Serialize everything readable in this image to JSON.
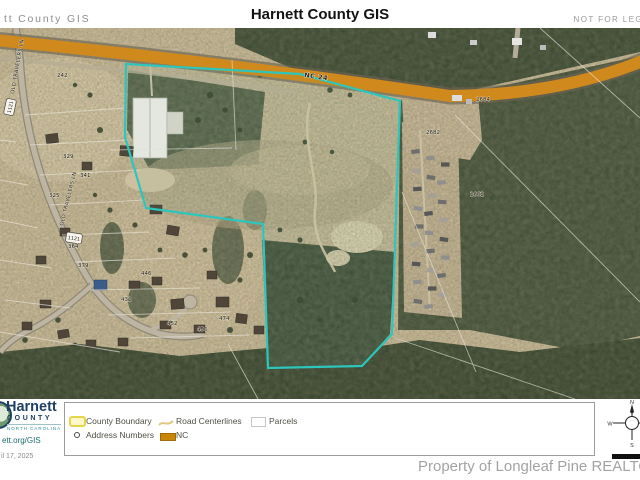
{
  "header": {
    "left_title": "tt County GIS",
    "title": "Harnett County GIS",
    "right_note": "NOT FOR LEG"
  },
  "map": {
    "highway_label": {
      "text": "NC 24",
      "x": 304,
      "y": 77,
      "rot": 8
    },
    "route_shields": [
      {
        "number": "1121",
        "x": 10,
        "y": 107,
        "rot": -78
      },
      {
        "number": "1121",
        "x": 74,
        "y": 238,
        "rot": 8
      }
    ],
    "road_name_labels": [
      {
        "text": "OLD TRAVELERS LN",
        "x": 14,
        "y": 94,
        "rot": -80
      },
      {
        "text": "OLD TRAVELERS LN",
        "x": 63,
        "y": 226,
        "rot": -76
      }
    ],
    "address_numbers": [
      {
        "t": "242",
        "x": 57,
        "y": 77
      },
      {
        "t": "329",
        "x": 63,
        "y": 158
      },
      {
        "t": "341",
        "x": 80,
        "y": 177
      },
      {
        "t": "325",
        "x": 49,
        "y": 197
      },
      {
        "t": "364",
        "x": 68,
        "y": 248
      },
      {
        "t": "379",
        "x": 78,
        "y": 267
      },
      {
        "t": "446",
        "x": 141,
        "y": 275
      },
      {
        "t": "432",
        "x": 121,
        "y": 301
      },
      {
        "t": "452",
        "x": 167,
        "y": 325
      },
      {
        "t": "456",
        "x": 197,
        "y": 331
      },
      {
        "t": "474",
        "x": 219,
        "y": 320
      },
      {
        "t": "2684",
        "x": 476,
        "y": 101
      },
      {
        "t": "2682",
        "x": 426,
        "y": 134
      },
      {
        "t": "2662",
        "x": 470,
        "y": 196
      }
    ],
    "colors": {
      "highlight_parcel": "#2cc6bd",
      "nc_highway": "#d0891c",
      "parcel_line": "#e8e4da"
    }
  },
  "legend": {
    "items": [
      {
        "label": "County Boundary",
        "symbol": "county-boundary-swatch"
      },
      {
        "label": "Road Centerlines",
        "symbol": "road-centerline-swatch"
      },
      {
        "label": "Parcels",
        "symbol": "parcel-swatch"
      },
      {
        "label": "Address Numbers",
        "symbol": "address-number-dot"
      },
      {
        "label": "NC",
        "symbol": "nc-road-swatch"
      }
    ]
  },
  "footer": {
    "logo": {
      "name": "Harnett",
      "subtitle": "COUNTY",
      "region": "NORTH CAROLINA"
    },
    "website": "ett.org/GIS",
    "date": "il 17, 2025",
    "watermark": "Property of Longleaf Pine REALTORS",
    "compass": {
      "north": "N",
      "west": "W",
      "south": "S"
    }
  }
}
